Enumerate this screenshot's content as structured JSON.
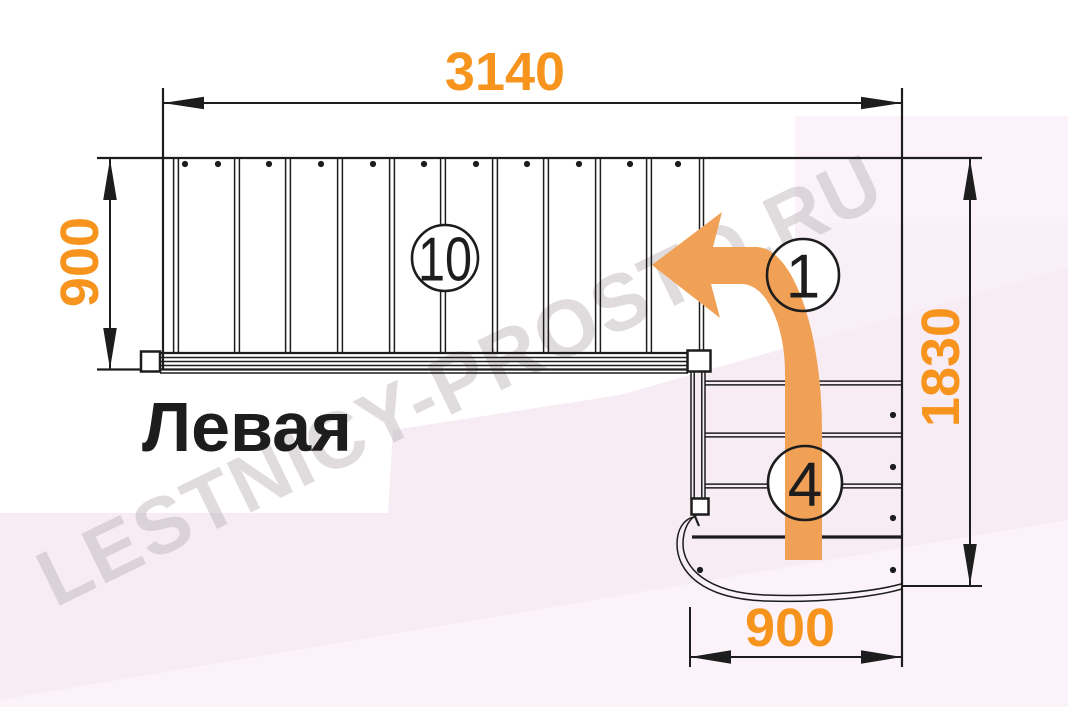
{
  "labels": {
    "orientation": "Левая",
    "watermark": "LESTNICY-PROSTO.RU"
  },
  "dimensions": {
    "total_length": "3140",
    "upper_flight_width": "900",
    "total_depth": "1830",
    "lower_flight_width": "900"
  },
  "badges": {
    "upper_flight_steps": "10",
    "turn_step": "1",
    "lower_flight_steps": "4"
  },
  "colors": {
    "dimension_text": "#f7941d",
    "arrow_fill": "#f0a155",
    "linework": "#1d1d1d",
    "watermark": "#b4abb1",
    "background_tint_1": "#f7ecf4",
    "background_tint_2": "#f9eff6",
    "background_tint_3": "#fbf3f9"
  }
}
